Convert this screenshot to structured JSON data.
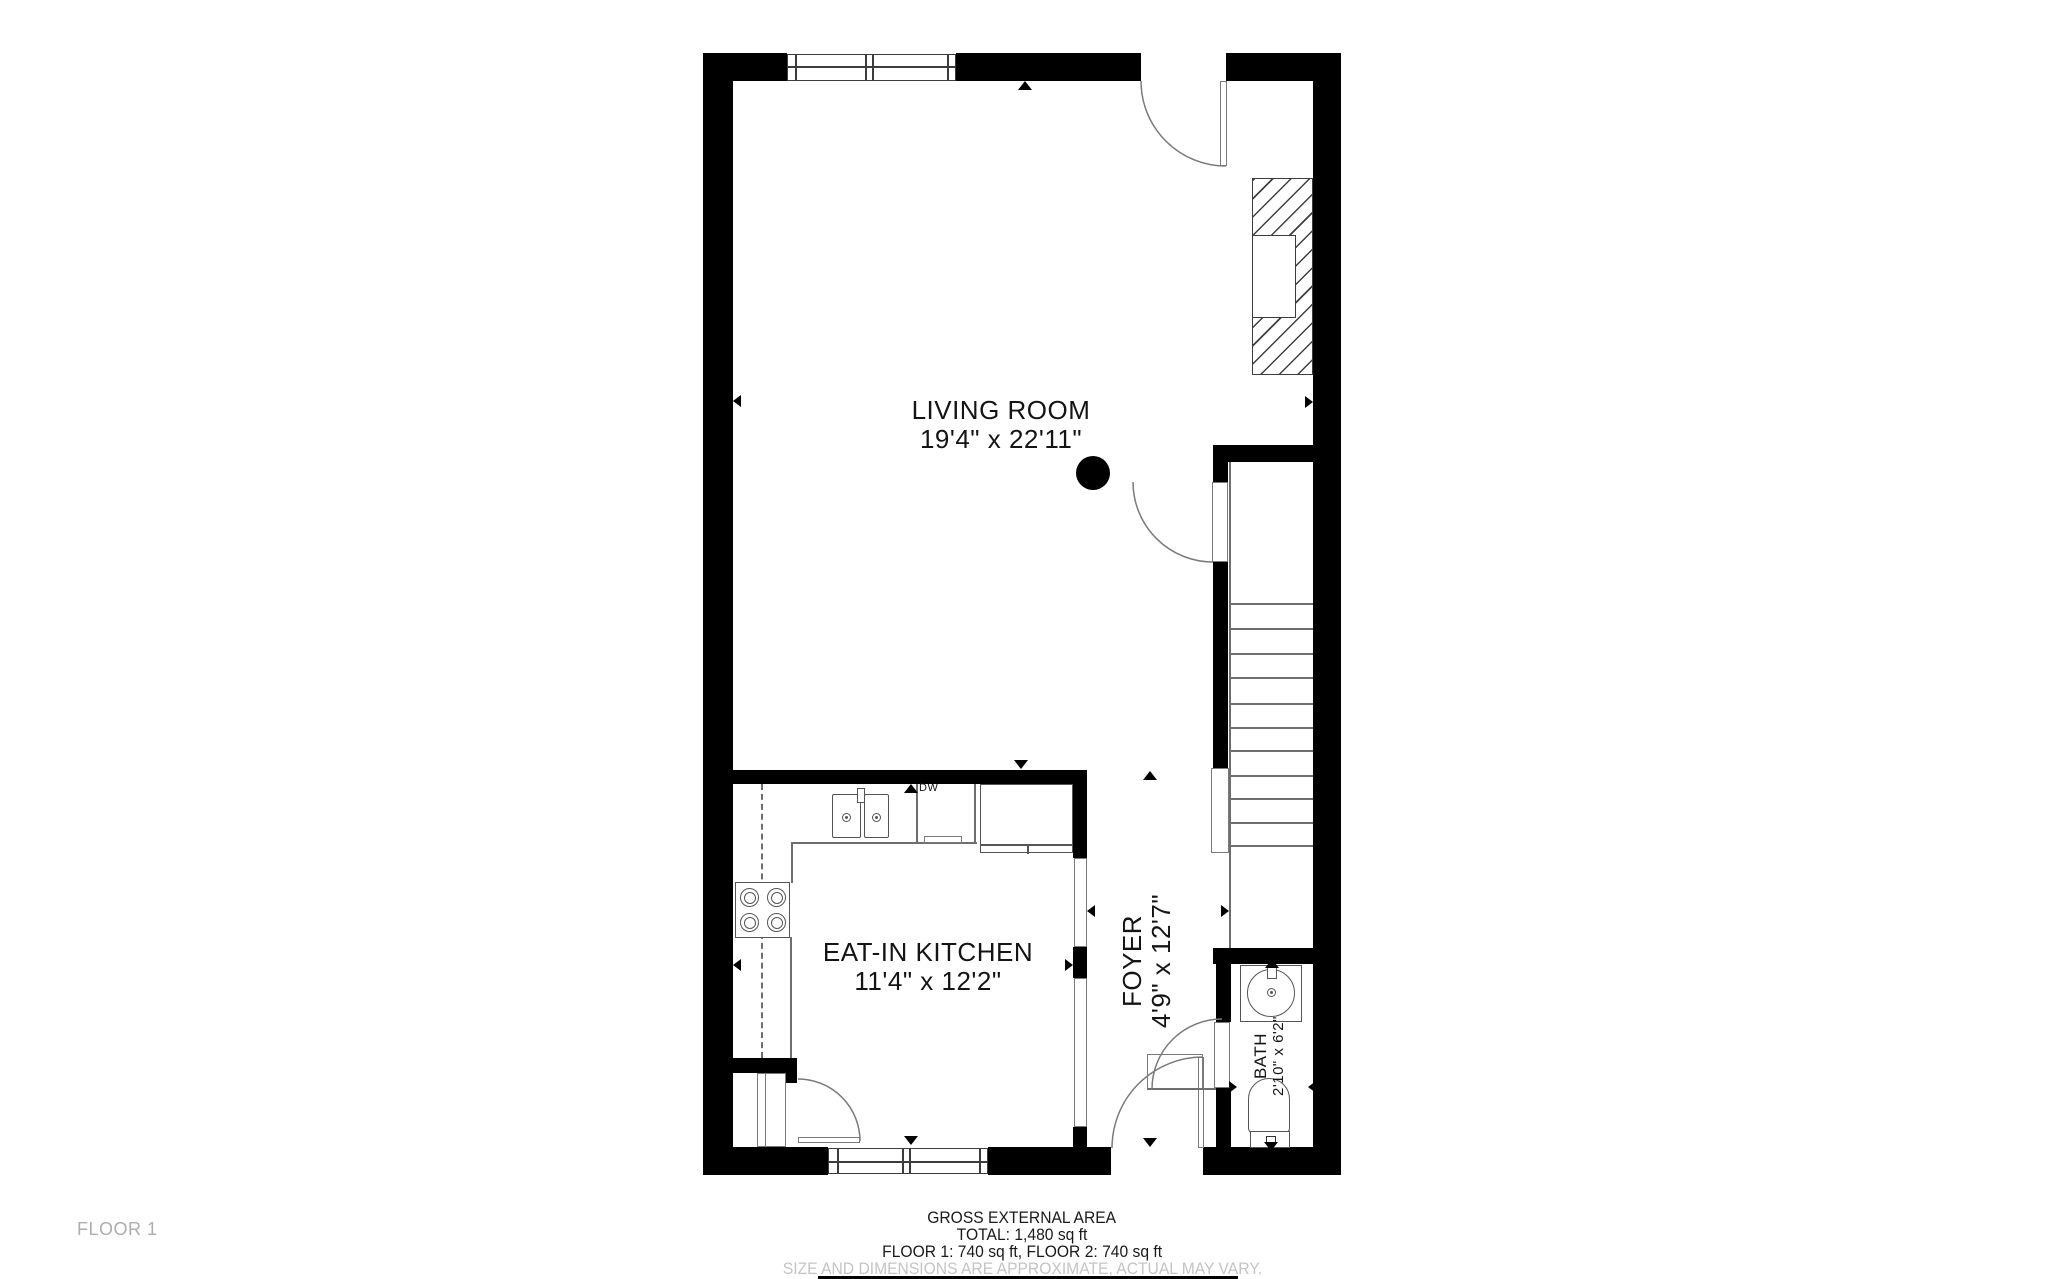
{
  "plan": {
    "rooms": {
      "living_room": {
        "name": "LIVING ROOM",
        "dims": "19'4\" x 22'11\""
      },
      "kitchen": {
        "name": "EAT-IN KITCHEN",
        "dims": "11'4\" x 12'2\""
      },
      "foyer": {
        "name": "FOYER",
        "dims": "4'9\" x 12'7\""
      },
      "bath": {
        "name": "BATH",
        "dims": "2'10\" x 6'2\""
      }
    },
    "appliance_labels": {
      "dishwasher": "DW"
    }
  },
  "footer": {
    "floor_label": "FLOOR 1",
    "area_title": "GROSS EXTERNAL AREA",
    "area_total": "TOTAL: 1,480 sq ft",
    "area_floors": "FLOOR 1: 740 sq ft, FLOOR 2: 740 sq ft",
    "disclaimer": "SIZE AND DIMENSIONS ARE APPROXIMATE, ACTUAL MAY VARY."
  },
  "colors": {
    "wall": "#000000",
    "fixture_line": "#6e6e6e",
    "text": "#1a1a1a",
    "muted_text": "#c4c4c4"
  }
}
